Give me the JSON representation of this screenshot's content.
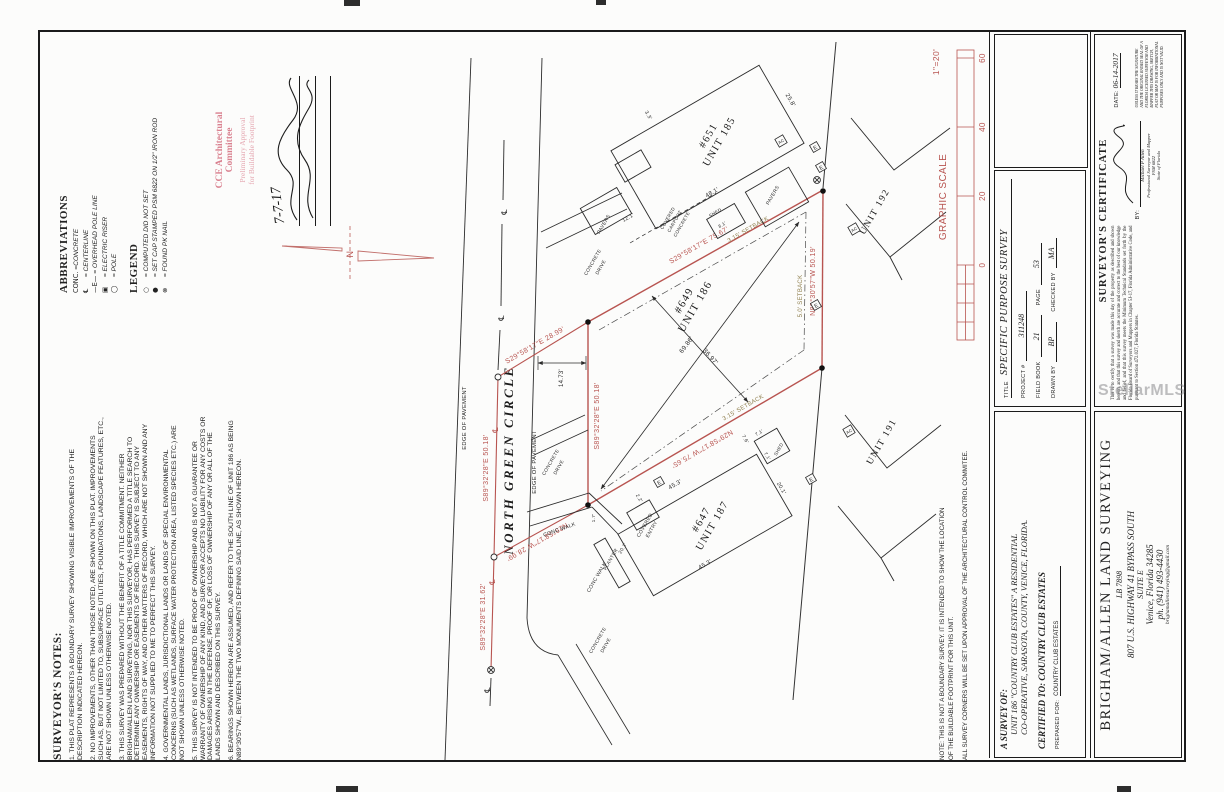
{
  "watermark": "StellarMLS",
  "abbreviations": {
    "title": "ABBREVIATIONS",
    "items": [
      {
        "sym": "CONC.",
        "desc": "=CONCRETE"
      },
      {
        "sym": "℄",
        "desc": "= CENTERLINE"
      },
      {
        "sym": "—E—",
        "desc": "= OVERHEAD POLE LINE"
      },
      {
        "sym": "▣",
        "desc": "= ELECTRIC RISER"
      },
      {
        "sym": "◯",
        "desc": "= POLE"
      }
    ]
  },
  "legend": {
    "title": "LEGEND",
    "items": [
      {
        "sym": "○",
        "desc": "= COMPUTED DID NOT SET"
      },
      {
        "sym": "●",
        "desc": "= SET CAP STAMPED PSM 6822 ON 1/2\" IRON ROD"
      },
      {
        "sym": "⊗",
        "desc": "= FOUND PK NAIL"
      }
    ]
  },
  "surveyors_notes": {
    "title": "SURVEYOR'S NOTES:",
    "notes": [
      "1. THIS PLAT REPRESENTS A BOUNDARY SURVEY SHOWING VISIBLE IMPROVEMENTS OF THE DESCRIPTION INDICATED HEREON.",
      "2. NO IMPROVEMENTS, OTHER THAN THOSE NOTED, ARE SHOWN ON THIS PLAT. IMPROVEMENTS SUCH AS, BUT NOT LIMITED TO, SUBSURFACE UTILITIES, FOUNDATIONS, LANDSCAPE FEATURES, ETC., ARE NOT SHOWN UNLESS OTHERWISE NOTED.",
      "3. THIS SURVEY WAS PREPARED WITHOUT THE BENEFIT OF A TITLE COMMITMENT. NEITHER BRIGHAM/ALLEN LAND SURVEYING, NOR THIS SURVEYOR, HAS PERFORMED A TITLE SEARCH TO DETERMINE ANY OWNERSHIP OR EASEMENTS OF RECORD. THIS SURVEY IS SUBJECT TO ANY EASEMENTS, RIGHTS OF WAY, AND OTHER MATTERS OF RECORD, WHICH ARE NOT SHOWN AND ANY INFORMATION NOT SUPPLIED TO ME TO PERFECT THIS SURVEY.",
      "4. GOVERNMENTAL LANDS, JURISDICTIONAL LANDS OR LANDS OF SPECIAL ENVIRONMENTAL CONCERNS (SUCH AS WETLANDS, SURFACE WATER PROTECTION AREA, LISTED SPECIES ETC.) ARE NOT SHOWN UNLESS OTHERWISE NOTED.",
      "5. THIS SURVEY IS NOT INTENDED TO BE PROOF OF OWNERSHIP AND IS NOT A GUARANTEE OR WARRANTY OF OWNERSHIP OF ANY KIND, AND SURVEYOR ACCEPTS NO LIABILITY FOR ANY COSTS OR DAMAGES ARISING IN THE DEFENSE, PROOF OF, OR LOSS OF OWNERSHIP OF ANY OR ALL OF THE LANDS SHOWN AND DESCRIBED ON THIS SURVEY.",
      "6. BEARINGS SHOWN HEREON ARE ASSUMED, AND REFER TO THE SOUTH LINE OF UNIT 186 AS BEING N89°30'57\"W., BETWEEN THE TWO MONUMENTS DEFINING SAID LINE, AS SHOWN HEREON."
    ]
  },
  "stamp": {
    "line1": "CCE Architectural",
    "line2": "Committee",
    "line3": "Preliminary Approval",
    "line4": "for Buildable Footprint",
    "date": "7-7-17"
  },
  "graphic_scale": {
    "title": "GRAPHIC SCALE",
    "ratio": "1\"=20'",
    "ticks": [
      "60",
      "40",
      "20",
      "0"
    ]
  },
  "drawing": {
    "street": {
      "name": "NORTH GREEN CIRCLE",
      "edge_label": "EDGE OF PAVEMENT"
    },
    "north_label": "N",
    "e_riser": "E",
    "ac": "AC",
    "bearings": {
      "tie_top": "S29°58'17\"E 28.99'",
      "ab": "S29°58'17\"E 75.67'",
      "cl_50": "S89°32'28\"E 50.18'",
      "cl_31": "S89°32'28\"E 31.62'",
      "west": "S89°32'28\"E 50.18'",
      "tie_bottom": "N29°58'17\"W 28.99'",
      "cd": "N29°58'17\"W 75.65'",
      "bc": "N89°30'57\"W 50.19'"
    },
    "setbacks": {
      "s315": "3.15' SETBACK",
      "s50": "5.0' SETBACK"
    },
    "dims": {
      "diag_long": "69.86'",
      "diag_short": "36.97'",
      "street_offset": "14.73'"
    },
    "labels": {
      "conc_walk": "CONC WALK",
      "concrete": "CONCRETE",
      "drive": "DRIVE"
    },
    "units": {
      "u185": {
        "number": "#651",
        "name": "UNIT 185",
        "d48": "48.1'",
        "d258": "25.8'",
        "d121": "12.1'",
        "d33": "3.3'",
        "d81": "8.1'",
        "shed": "SHED",
        "covered1": "COVERED",
        "covered2": "CARPORT",
        "covered3": "CONCRETE",
        "pavers": "PAVERS"
      },
      "u186": {
        "number": "#649",
        "name": "UNIT 186"
      },
      "u187": {
        "number": "#647",
        "name": "UNIT 187",
        "d453": "45.3'",
        "d201": "20.1'",
        "d76": "7.6'",
        "d22": "2.2'",
        "d17": "1.7'",
        "d71": "7.1'",
        "shed": "SHED",
        "covered1": "COVERED",
        "covered2": "ENTRY",
        "planter": "PLANTER",
        "walk_201": "20.1'"
      },
      "u191": {
        "name": "UNIT 191"
      },
      "u192": {
        "name": "UNIT 192"
      }
    }
  },
  "note_block": {
    "lines": [
      "NOTE: THIS IS NOT A BOUNDARY SURVEY. IT IS INTENDED TO SHOW THE LOCATION",
      "OF THE BUILDABLE FOOTPRINT FOR THIS UNIT.",
      "ALL SURVEY CORNERS WILL BE SET UPON APPROVAL OF THE ARCHITECTURAL CONTROL COMMITEE."
    ]
  },
  "title_block": {
    "project_box": {
      "title_label": "TITLE",
      "title": "SPECIFIC PURPOSE SURVEY",
      "project_label": "PROJECT #",
      "project": "311248",
      "field_book_label": "FIELD BOOK",
      "field_book": "21",
      "page_label": "PAGE",
      "page": "53",
      "drawn_by_label": "DRAWN BY",
      "drawn_by": "BP",
      "checked_by_label": "CHECKED BY",
      "checked_by": "MA"
    },
    "survey_of": {
      "heading": "A SURVEY OF:",
      "line1": "UNIT 186 \"COUNTRY CLUB ESTATES\" A RESIDENTIAL",
      "line2": "CO-OPERATIVE, SARASOTA, COUNTY, VENICE, FLORIDA.",
      "certified": "CERTIFIED TO: COUNTRY CLUB ESTATES",
      "prepared_label": "PREPARED FOR:",
      "prepared": "COUNTRY CLUB ESTATES"
    },
    "certificate": {
      "heading": "SURVEYOR'S CERTIFICATE",
      "body": "This is to certify that a survey was made this day of the property as described and shown hereon, and that this survey and sketch are accurate and correct to the best of our knowledge and belief, and that this survey meets the Minimum Technical Standards set forth by the Florida Board of Surveyors and Mappers in Chapter 5J-17, Florida Administrative Code, and pursuant to Section 472.027, Florida Statutes.",
      "date_label": "DATE:",
      "date": "06-14-2017",
      "by_label": "BY:",
      "surveyor": "Michael P Allen",
      "surveyor_title": "Professional Surveyor and Mapper",
      "psm": "PSM 6822",
      "state": "State of Florida",
      "disclaimer": "UNLESS IT BEARS THE SIGNATURE AND THE ORIGINAL RAISED SEAL OF A FLORIDA LICENSED SURVEYOR AND MAPPER THIS DRAWING, SKETCH, PLAT OR MAP IS FOR INFORMATIONAL PURPOSES ONLY AND IS NOT VALID."
    },
    "company": {
      "name": "BRIGHAM/ALLEN LAND SURVEYING",
      "lb": "LB 7898",
      "addr1": "807 U.S. HIGHWAY 41 BYPASS SOUTH",
      "addr2": "SUITE E",
      "addr3": "Venice, Florida 34285",
      "phone": "ph. (941) 493-4430",
      "email": "brighamallensurveying@gmail.com"
    }
  }
}
